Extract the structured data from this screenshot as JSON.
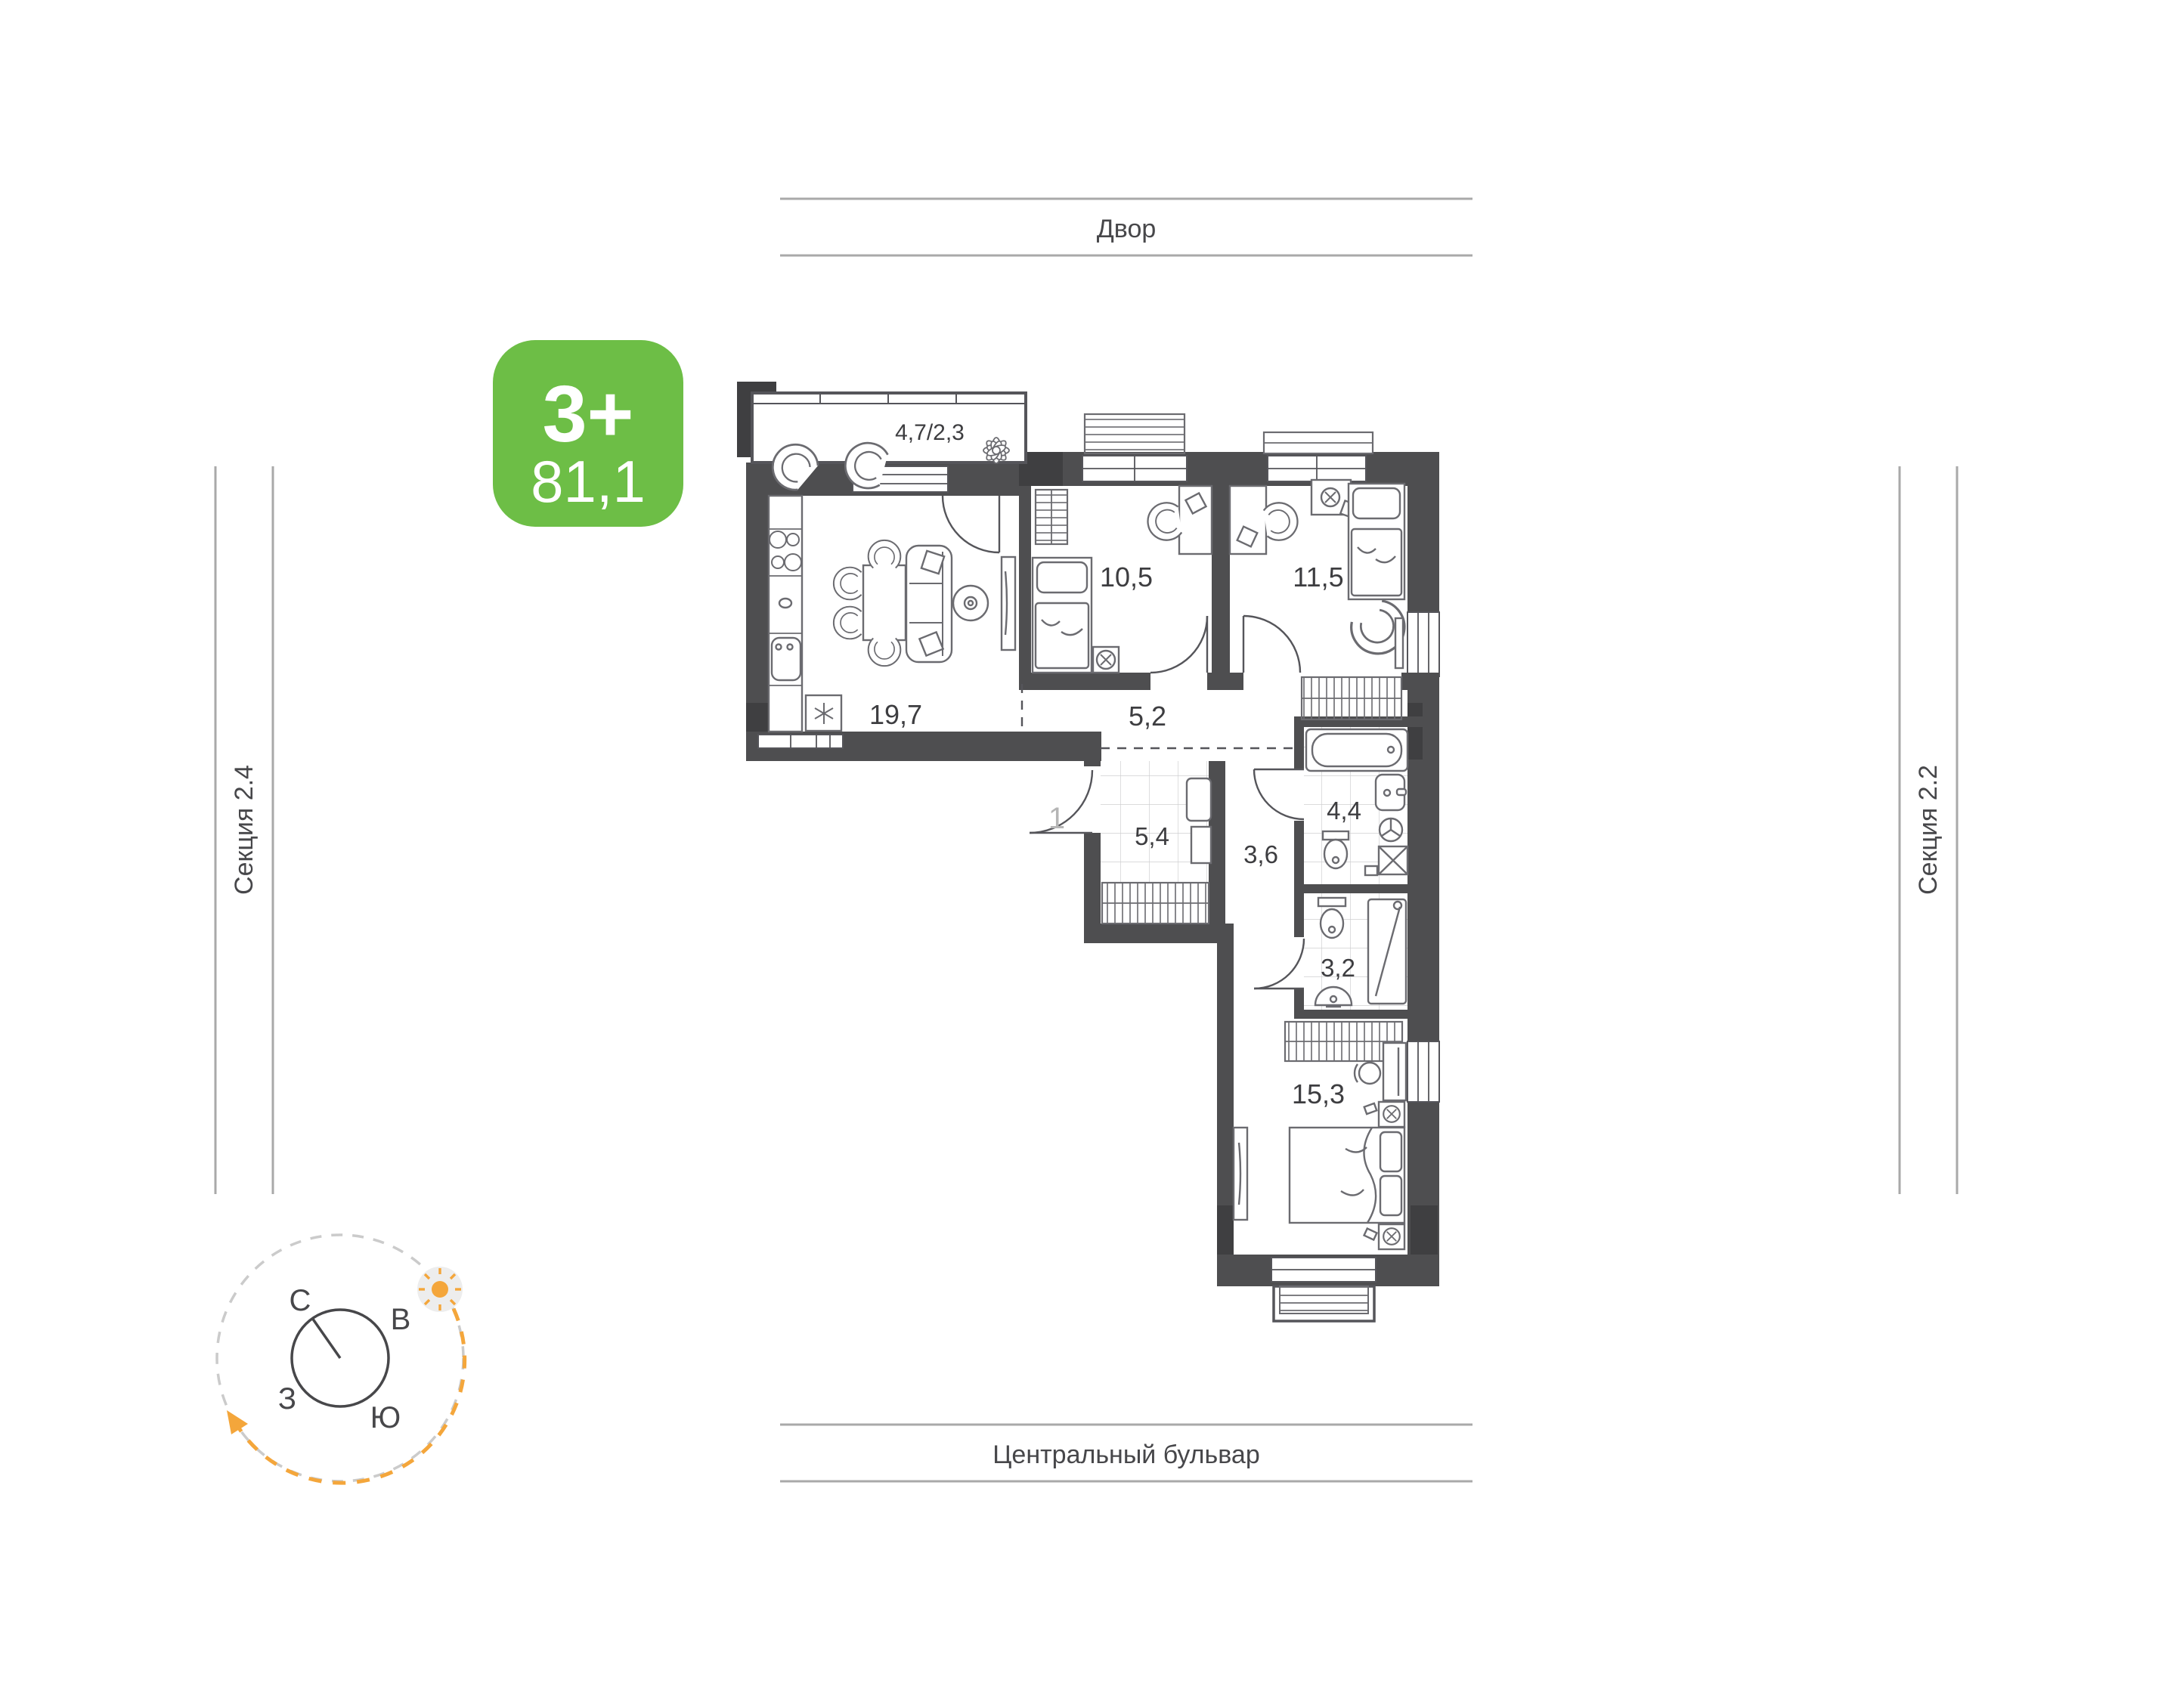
{
  "apartment_card": {
    "rooms_label": "3+",
    "area_value": "81,1"
  },
  "surroundings": {
    "street_top": "Двор",
    "street_bottom": "Центральный бульвар",
    "section_left": "Секция 2.4",
    "section_right": "Секция 2.2"
  },
  "compass": {
    "north": "С",
    "east": "В",
    "west": "З",
    "south": "Ю"
  },
  "plan": {
    "entrance_label": "1",
    "rooms": {
      "balcony": {
        "label": "4,7/2,3"
      },
      "living_kitchen": {
        "label": "19,7"
      },
      "bedroom_small": {
        "label": "10,5"
      },
      "bedroom_middle": {
        "label": "11,5"
      },
      "hallway": {
        "label": "5,2"
      },
      "entry_hall": {
        "label": "5,4"
      },
      "corridor": {
        "label": "3,6"
      },
      "bathroom": {
        "label": "4,4"
      },
      "shower_room": {
        "label": "3,2"
      },
      "bedroom_master": {
        "label": "15,3"
      }
    }
  },
  "colors": {
    "badge_green": "#6DBE46",
    "compass_orange": "#F4A63B",
    "walls": "#4E4E50",
    "context_lines": "#A9A9A9"
  }
}
